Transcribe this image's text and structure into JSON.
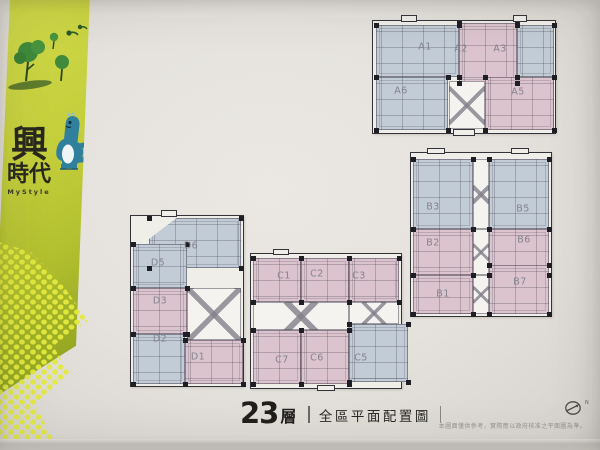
{
  "brand": {
    "char1": "興",
    "char2": "時",
    "char3": "代",
    "subtitle": "MyStyle"
  },
  "caption": {
    "floor_number": "23",
    "floor_suffix": "層",
    "title": "全區平面配置圖"
  },
  "compass": {
    "label": "N"
  },
  "disclaimer": "本圖面僅供參考，實際應以政府核准之平面圖為準。",
  "colors": {
    "unit_pink": "#dcc4ce",
    "unit_blue": "#c2ccd7",
    "banner_green_top": "#ced747",
    "banner_green_bottom": "#86981a",
    "dots_yellow": "#e3e93f",
    "wall": "#34333a",
    "label_gray": "#83838e"
  },
  "buildings": [
    {
      "id": "A",
      "x": 372,
      "y": 20,
      "w": 182,
      "h": 112,
      "units": [
        {
          "label": "A1",
          "color": "blue",
          "x": 3,
          "y": 4,
          "w": 83,
          "h": 52,
          "lx": 52,
          "ly": 26
        },
        {
          "label": "A2",
          "color": "pink",
          "x": 86,
          "y": 2,
          "w": 58,
          "h": 60,
          "lx": 88,
          "ly": 28
        },
        {
          "label": "A3",
          "color": "blue",
          "x": 144,
          "y": 4,
          "w": 37,
          "h": 52,
          "lx": 127,
          "ly": 28
        },
        {
          "label": "A6",
          "color": "blue",
          "x": 3,
          "y": 56,
          "w": 72,
          "h": 53,
          "lx": 28,
          "ly": 70
        },
        {
          "label": "A5",
          "color": "pink",
          "x": 112,
          "y": 56,
          "w": 69,
          "h": 53,
          "lx": 145,
          "ly": 71
        }
      ],
      "cores": [
        {
          "x": 76,
          "y": 60,
          "w": 36,
          "h": 48
        }
      ],
      "bumps": [
        {
          "x": 28,
          "y": -6,
          "w": 16,
          "h": 7
        },
        {
          "x": 140,
          "y": -6,
          "w": 14,
          "h": 7
        },
        {
          "x": 80,
          "y": 108,
          "w": 22,
          "h": 7
        }
      ]
    },
    {
      "id": "B",
      "x": 410,
      "y": 152,
      "w": 140,
      "h": 163,
      "units": [
        {
          "label": "B3",
          "color": "blue",
          "x": 2,
          "y": 6,
          "w": 60,
          "h": 70,
          "lx": 22,
          "ly": 54
        },
        {
          "label": "B5",
          "color": "blue",
          "x": 78,
          "y": 6,
          "w": 60,
          "h": 70,
          "lx": 112,
          "ly": 56
        },
        {
          "label": "B2",
          "color": "pink",
          "x": 2,
          "y": 76,
          "w": 60,
          "h": 46,
          "lx": 22,
          "ly": 90
        },
        {
          "label": "B6",
          "color": "pink",
          "x": 78,
          "y": 76,
          "w": 60,
          "h": 46,
          "lx": 113,
          "ly": 87
        },
        {
          "label": "B1",
          "color": "pink",
          "x": 2,
          "y": 122,
          "w": 60,
          "h": 39,
          "lx": 32,
          "ly": 141
        },
        {
          "label": "B7",
          "color": "pink",
          "x": 78,
          "y": 112,
          "w": 60,
          "h": 49,
          "lx": 109,
          "ly": 129
        }
      ],
      "cores": [
        {
          "x": 62,
          "y": 6,
          "w": 16,
          "h": 70
        },
        {
          "x": 62,
          "y": 76,
          "w": 16,
          "h": 46
        },
        {
          "x": 62,
          "y": 122,
          "w": 16,
          "h": 39
        }
      ],
      "bumps": [
        {
          "x": 16,
          "y": -5,
          "w": 18,
          "h": 6
        },
        {
          "x": 100,
          "y": -5,
          "w": 18,
          "h": 6
        }
      ]
    },
    {
      "id": "C",
      "x": 250,
      "y": 253,
      "w": 150,
      "h": 134,
      "units": [
        {
          "label": "C1",
          "color": "pink",
          "x": 2,
          "y": 4,
          "w": 48,
          "h": 44,
          "lx": 33,
          "ly": 22
        },
        {
          "label": "C2",
          "color": "pink",
          "x": 50,
          "y": 4,
          "w": 48,
          "h": 44,
          "lx": 66,
          "ly": 20
        },
        {
          "label": "C3",
          "color": "pink",
          "x": 98,
          "y": 4,
          "w": 50,
          "h": 44,
          "lx": 108,
          "ly": 22
        },
        {
          "label": "C7",
          "color": "pink",
          "x": 2,
          "y": 76,
          "w": 48,
          "h": 54,
          "lx": 31,
          "ly": 106
        },
        {
          "label": "C6",
          "color": "pink",
          "x": 50,
          "y": 76,
          "w": 48,
          "h": 54,
          "lx": 66,
          "ly": 104
        },
        {
          "label": "C5",
          "color": "blue",
          "x": 98,
          "y": 70,
          "w": 59,
          "h": 58,
          "lx": 110,
          "ly": 104
        }
      ],
      "cores": [
        {
          "x": 2,
          "y": 48,
          "w": 96,
          "h": 28
        },
        {
          "x": 98,
          "y": 48,
          "w": 50,
          "h": 22
        }
      ],
      "bumps": [
        {
          "x": 22,
          "y": -5,
          "w": 16,
          "h": 6
        },
        {
          "x": 66,
          "y": 131,
          "w": 18,
          "h": 6
        }
      ]
    },
    {
      "id": "D",
      "x": 130,
      "y": 215,
      "w": 112,
      "h": 170,
      "units": [
        {
          "label": "D6",
          "color": "blue",
          "x": 18,
          "y": 2,
          "w": 92,
          "h": 50,
          "lx": 60,
          "ly": 30,
          "clip": "polygon(0 100%, 0 42%, 30% 0, 100% 0, 100% 100%)"
        },
        {
          "label": "D5",
          "color": "blue",
          "x": 2,
          "y": 28,
          "w": 54,
          "h": 44,
          "lx": 27,
          "ly": 47
        },
        {
          "label": "D3",
          "color": "pink",
          "x": 2,
          "y": 72,
          "w": 54,
          "h": 46,
          "lx": 29,
          "ly": 85
        },
        {
          "label": "D2",
          "color": "blue",
          "x": 2,
          "y": 118,
          "w": 52,
          "h": 50,
          "lx": 29,
          "ly": 123
        },
        {
          "label": "D1",
          "color": "pink",
          "x": 54,
          "y": 124,
          "w": 58,
          "h": 44,
          "lx": 67,
          "ly": 141
        }
      ],
      "cores": [
        {
          "x": 56,
          "y": 72,
          "w": 54,
          "h": 52
        }
      ],
      "bumps": [
        {
          "x": 30,
          "y": -6,
          "w": 16,
          "h": 7
        }
      ]
    }
  ]
}
